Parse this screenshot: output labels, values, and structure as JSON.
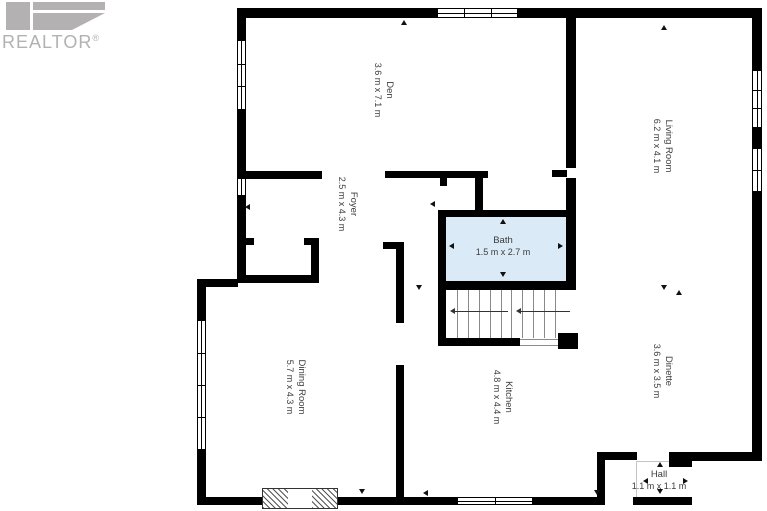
{
  "branding": {
    "logo_text": "REALTOR",
    "reg": "®"
  },
  "floorplan": {
    "colors": {
      "wall": "#000000",
      "highlight": "#daeaf6",
      "label": "#3c3c3c"
    },
    "rooms": [
      {
        "id": "den",
        "name": "Den",
        "dims": "3.6 m x 7.1 m",
        "cx": 383,
        "cy": 90,
        "rot": true,
        "highlight": false
      },
      {
        "id": "living-room",
        "name": "Living Room",
        "dims": "6.2 m x 4.1 m",
        "cx": 662,
        "cy": 146,
        "rot": true,
        "highlight": false
      },
      {
        "id": "foyer",
        "name": "Foyer",
        "dims": "2.5 m x 4.3 m",
        "cx": 347,
        "cy": 204,
        "rot": true,
        "highlight": false
      },
      {
        "id": "bath",
        "name": "Bath",
        "dims": "1.5 m x 2.7 m",
        "cx": 503,
        "cy": 247,
        "rot": false,
        "highlight": true
      },
      {
        "id": "dining-room",
        "name": "Dining Room",
        "dims": "5.7 m x 4.3 m",
        "cx": 295,
        "cy": 387,
        "rot": true,
        "highlight": false
      },
      {
        "id": "kitchen",
        "name": "Kitchen",
        "dims": "4.8 m x 4.4 m",
        "cx": 502,
        "cy": 397,
        "rot": true,
        "highlight": false
      },
      {
        "id": "dinette",
        "name": "Dinette",
        "dims": "3.6 m x 3.5 m",
        "cx": 662,
        "cy": 371,
        "rot": true,
        "highlight": false
      },
      {
        "id": "hall",
        "name": "Hall",
        "dims": "1.1 m x 1.1 m",
        "cx": 659,
        "cy": 481,
        "rot": false,
        "highlight": false
      }
    ],
    "highlight_region": {
      "x": 446,
      "y": 216,
      "w": 121,
      "h": 66
    },
    "walls": [
      [
        237,
        8,
        200,
        10
      ],
      [
        518,
        8,
        244,
        10
      ],
      [
        752,
        8,
        10,
        62
      ],
      [
        752,
        128,
        10,
        20
      ],
      [
        752,
        192,
        10,
        260
      ],
      [
        690,
        452,
        72,
        9
      ],
      [
        669,
        452,
        23,
        15
      ],
      [
        633,
        497,
        59,
        8
      ],
      [
        533,
        497,
        72,
        8
      ],
      [
        338,
        497,
        119,
        8
      ],
      [
        197,
        497,
        65,
        8
      ],
      [
        197,
        279,
        41,
        8
      ],
      [
        197,
        280,
        9,
        40
      ],
      [
        197,
        450,
        9,
        55
      ],
      [
        237,
        8,
        9,
        32
      ],
      [
        237,
        110,
        9,
        68
      ],
      [
        237,
        196,
        9,
        49
      ],
      [
        237,
        245,
        9,
        38
      ],
      [
        237,
        275,
        82,
        8
      ],
      [
        311,
        245,
        8,
        38
      ],
      [
        244,
        238,
        10,
        7
      ],
      [
        304,
        238,
        15,
        7
      ],
      [
        237,
        171,
        85,
        8
      ],
      [
        385,
        171,
        103,
        7
      ],
      [
        440,
        178,
        7,
        8
      ],
      [
        475,
        178,
        8,
        34
      ],
      [
        566,
        8,
        10,
        160
      ],
      [
        552,
        170,
        15,
        7
      ],
      [
        566,
        178,
        10,
        112
      ],
      [
        438,
        210,
        138,
        7
      ],
      [
        438,
        210,
        8,
        80
      ],
      [
        438,
        281,
        138,
        9
      ],
      [
        438,
        290,
        8,
        56
      ],
      [
        438,
        338,
        82,
        8
      ],
      [
        558,
        333,
        20,
        16
      ],
      [
        383,
        242,
        21,
        7
      ],
      [
        396,
        242,
        8,
        81
      ],
      [
        396,
        365,
        8,
        140
      ],
      [
        597,
        452,
        8,
        53
      ],
      [
        605,
        452,
        32,
        8
      ]
    ],
    "windows": [
      [
        437,
        8,
        81,
        10,
        "h",
        2
      ],
      [
        752,
        70,
        10,
        58,
        "v",
        2
      ],
      [
        752,
        148,
        10,
        44,
        "v",
        1
      ],
      [
        237,
        40,
        9,
        70,
        "v",
        2
      ],
      [
        237,
        178,
        9,
        18,
        "v",
        0
      ],
      [
        197,
        320,
        9,
        130,
        "v",
        3
      ],
      [
        457,
        497,
        76,
        8,
        "h",
        1
      ]
    ],
    "fireplace": {
      "x": 262,
      "y": 488,
      "w": 76,
      "h": 21,
      "hatch_w": 25
    },
    "stairs": {
      "x": 446,
      "y": 290,
      "w": 120,
      "h": 48,
      "treads": 10,
      "arrows": [
        [
          450,
          311,
          58
        ],
        [
          516,
          311,
          54
        ]
      ],
      "rails": [
        [
          520,
          339,
          46
        ],
        [
          520,
          345,
          46
        ]
      ]
    },
    "thin_lines": [
      [
        636,
        461,
        1,
        36
      ],
      [
        637,
        461,
        32,
        1
      ]
    ],
    "dim_arrows": [
      [
        404,
        22,
        "u"
      ],
      [
        664,
        27,
        "u"
      ],
      [
        247,
        207,
        "l"
      ],
      [
        432,
        204,
        "l"
      ],
      [
        503,
        221,
        "u"
      ],
      [
        503,
        275,
        "d"
      ],
      [
        451,
        246,
        "l"
      ],
      [
        561,
        246,
        "r"
      ],
      [
        419,
        288,
        "d"
      ],
      [
        664,
        288,
        "d"
      ],
      [
        679,
        292,
        "u"
      ],
      [
        362,
        492,
        "d"
      ],
      [
        425,
        493,
        "l"
      ],
      [
        597,
        493,
        "d"
      ],
      [
        660,
        464,
        "u"
      ],
      [
        660,
        492,
        "d"
      ],
      [
        645,
        481,
        "l"
      ],
      [
        686,
        481,
        "r"
      ]
    ]
  }
}
